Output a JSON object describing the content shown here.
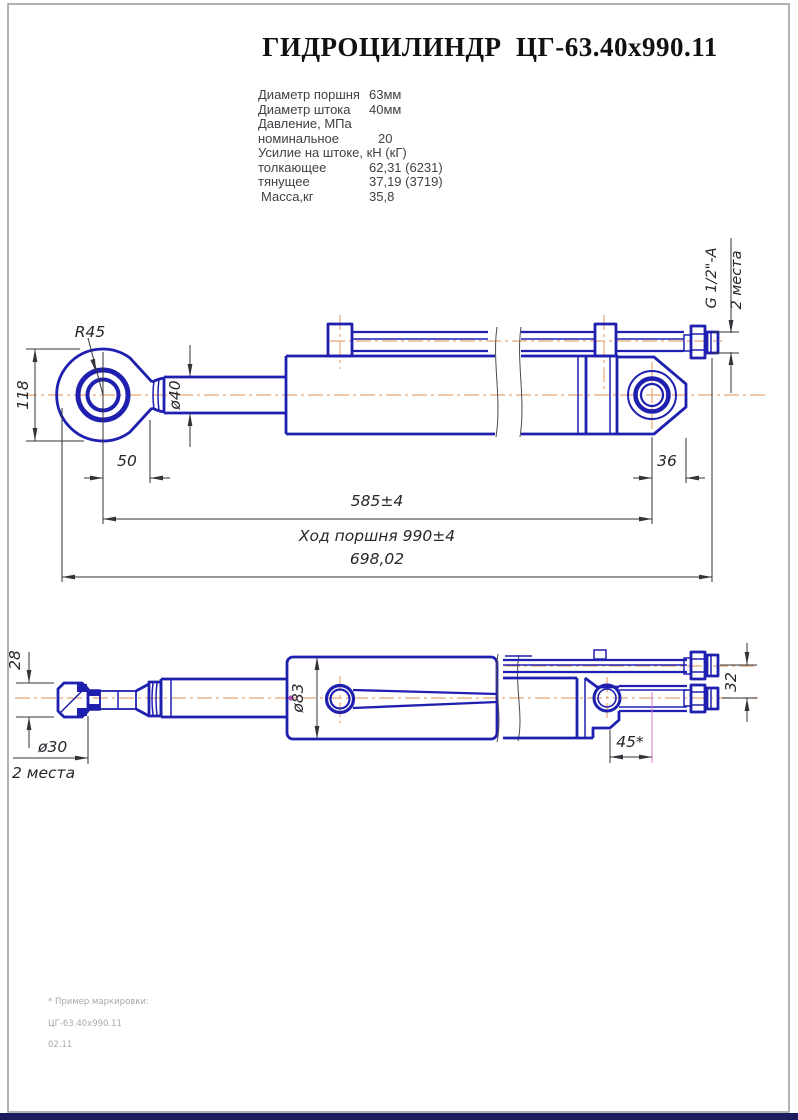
{
  "title": "ГИДРОЦИЛИНДР  ЦГ-63.40x990.11",
  "specs": {
    "rows": [
      {
        "label": "Диаметр поршня",
        "value": "63мм"
      },
      {
        "label": "Диаметр штока",
        "value": "40мм"
      },
      {
        "label": "Давление, МПа",
        "value": ""
      },
      {
        "label": "номинальное",
        "value": "20"
      },
      {
        "label": "Усилие на штоке, кН (кГ)",
        "value": ""
      },
      {
        "label": "толкающее",
        "value": "62,31 (6231)"
      },
      {
        "label": "тянущее",
        "value": "37,19 (3719)"
      },
      {
        "label": "Масса,кг",
        "value": "35,8"
      }
    ]
  },
  "view1": {
    "radius": "R45",
    "height": "118",
    "rod_dia": "ø40",
    "eye_offset": "50",
    "length_585": "585±4",
    "stroke_note": "Ход поршня 990±4",
    "total_length": "698,02",
    "clevis_36": "36",
    "thread": "G 1/2\"-A",
    "thread_places": "2 места"
  },
  "view2": {
    "eye_width": "28",
    "hole_dia": "ø30",
    "hole_places": "2 места",
    "body_dia": "ø83",
    "port_spacing": "45*",
    "fitting_spacing": "32"
  },
  "footnote": {
    "line1": "* Пример маркировки:",
    "line2": "ЦГ-63.40х990.11",
    "line3": "02.11"
  },
  "colors": {
    "outline": "#1f1fb0",
    "centerline": "#e8a874",
    "dimension": "#33333a",
    "accent": "#b44fb4",
    "frame": "#999999",
    "footer_bar": "#1b1b5e"
  }
}
